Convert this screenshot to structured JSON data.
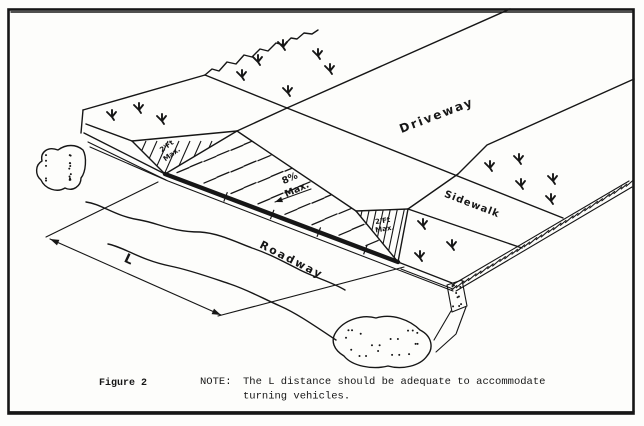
{
  "figure_caption": "Figure 2",
  "note": {
    "prefix": "NOTE:",
    "line1": "The L distance should be adequate to accommodate",
    "line2": "turning vehicles."
  },
  "areas": {
    "driveway": "Driveway",
    "sidewalk": "Sidewalk",
    "roadway": "Roadway"
  },
  "annotations": {
    "ramp_slope_value": "8%",
    "ramp_slope_qualifier": "Max.",
    "flare_left_line1": "2'Ft",
    "flare_left_line2": "Max.",
    "flare_right_line1": "2'Ft",
    "flare_right_line2": "Max.",
    "length_dimension": "L"
  },
  "colors": {
    "ink": "#161616",
    "paper": "#fdfdfb"
  }
}
